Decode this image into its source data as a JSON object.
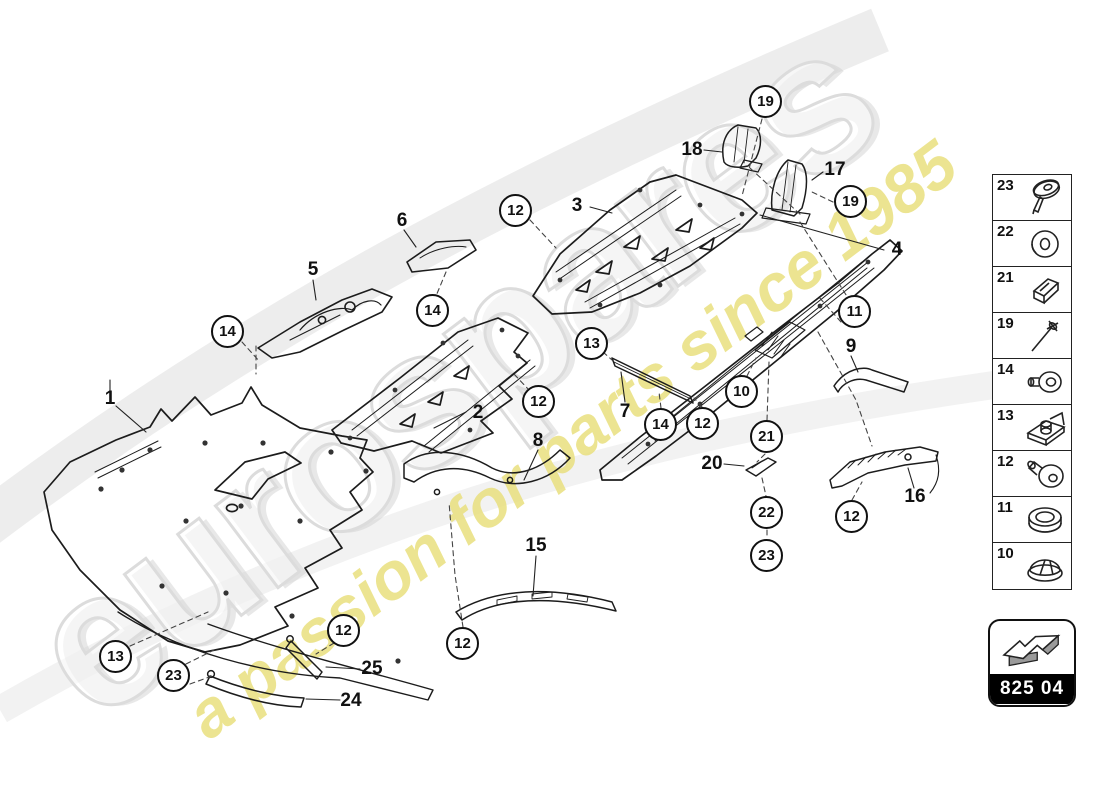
{
  "watermark": {
    "brand": "eurospares",
    "tagline": "a passion for parts since 1985"
  },
  "part_code": {
    "label": "825 04"
  },
  "colors": {
    "line": "#1c1c1c",
    "accent_yellow": "#e9df7e",
    "watermark_gray": "#dcdcdc",
    "code_band_bg": "#000000",
    "code_band_text": "#ffffff"
  },
  "diagram": {
    "callouts": [
      {
        "n": "19",
        "x": 766,
        "y": 102
      },
      {
        "n": "12",
        "x": 516,
        "y": 211
      },
      {
        "n": "19",
        "x": 851,
        "y": 202
      },
      {
        "n": "14",
        "x": 228,
        "y": 332
      },
      {
        "n": "14",
        "x": 433,
        "y": 311
      },
      {
        "n": "12",
        "x": 539,
        "y": 402
      },
      {
        "n": "13",
        "x": 592,
        "y": 344
      },
      {
        "n": "14",
        "x": 661,
        "y": 425
      },
      {
        "n": "12",
        "x": 703,
        "y": 424
      },
      {
        "n": "10",
        "x": 742,
        "y": 392
      },
      {
        "n": "21",
        "x": 767,
        "y": 437
      },
      {
        "n": "22",
        "x": 767,
        "y": 513
      },
      {
        "n": "23",
        "x": 767,
        "y": 556
      },
      {
        "n": "11",
        "x": 855,
        "y": 312
      },
      {
        "n": "12",
        "x": 852,
        "y": 517
      },
      {
        "n": "13",
        "x": 116,
        "y": 657
      },
      {
        "n": "23",
        "x": 174,
        "y": 676
      },
      {
        "n": "12",
        "x": 344,
        "y": 631
      },
      {
        "n": "12",
        "x": 463,
        "y": 644
      }
    ],
    "labels": [
      {
        "n": "1",
        "x": 110,
        "y": 399
      },
      {
        "n": "2",
        "x": 478,
        "y": 413
      },
      {
        "n": "3",
        "x": 577,
        "y": 206
      },
      {
        "n": "4",
        "x": 897,
        "y": 250
      },
      {
        "n": "5",
        "x": 313,
        "y": 270
      },
      {
        "n": "6",
        "x": 402,
        "y": 221
      },
      {
        "n": "7",
        "x": 625,
        "y": 412
      },
      {
        "n": "8",
        "x": 538,
        "y": 441
      },
      {
        "n": "9",
        "x": 851,
        "y": 347
      },
      {
        "n": "15",
        "x": 536,
        "y": 546
      },
      {
        "n": "16",
        "x": 915,
        "y": 497
      },
      {
        "n": "17",
        "x": 835,
        "y": 170
      },
      {
        "n": "18",
        "x": 692,
        "y": 150
      },
      {
        "n": "20",
        "x": 712,
        "y": 464
      },
      {
        "n": "24",
        "x": 351,
        "y": 701
      },
      {
        "n": "25",
        "x": 372,
        "y": 669
      }
    ]
  },
  "sidebar": {
    "items": [
      {
        "number": "23",
        "icon": "push-rivet-icon"
      },
      {
        "number": "22",
        "icon": "washer-icon"
      },
      {
        "number": "21",
        "icon": "spring-clip-icon"
      },
      {
        "number": "19",
        "icon": "blind-rivet-icon"
      },
      {
        "number": "14",
        "icon": "round-head-screw-icon"
      },
      {
        "number": "13",
        "icon": "mounting-clip-icon"
      },
      {
        "number": "12",
        "icon": "flat-head-fastener-icon"
      },
      {
        "number": "11",
        "icon": "grommet-icon"
      },
      {
        "number": "10",
        "icon": "cap-plug-icon"
      }
    ]
  }
}
